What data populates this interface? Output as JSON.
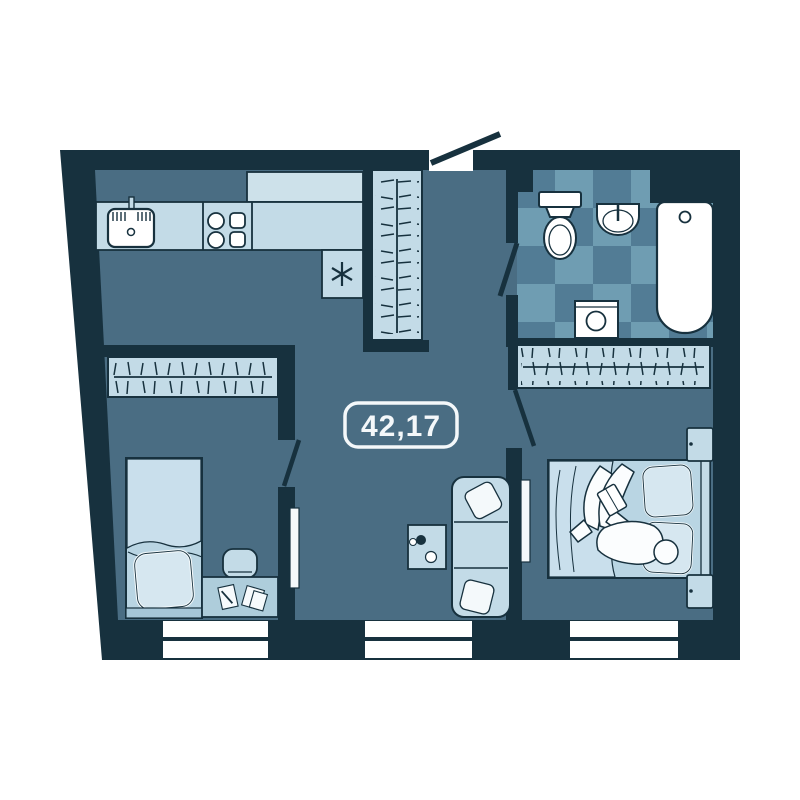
{
  "plan": {
    "type": "apartment-floor-plan",
    "area_label": "42,17",
    "windows_count": 3,
    "rooms": [
      {
        "name": "kitchen-hall",
        "fixtures": [
          "kitchen-sink",
          "stove-4-burners",
          "kitchen-counter",
          "fridge-snowflake",
          "tall-wardrobe-hangers"
        ]
      },
      {
        "name": "bathroom",
        "fixtures": [
          "toilet",
          "washbasin",
          "bathtub",
          "washing-machine",
          "checker-tile-floor"
        ]
      },
      {
        "name": "bedroom-left",
        "fixtures": [
          "single-bed",
          "pillow",
          "desk",
          "chair",
          "papers",
          "wardrobe-hangers"
        ]
      },
      {
        "name": "bedroom-right",
        "fixtures": [
          "double-bed",
          "person-reading-book",
          "nightstand",
          "nightstand",
          "wardrobe-hangers"
        ]
      },
      {
        "name": "living-area",
        "fixtures": [
          "sofa-3-seat",
          "sofa-pillows",
          "coffee-table"
        ]
      }
    ],
    "doors": [
      "entrance-door-swing",
      "bathroom-door-swing",
      "bedroom-left-door-swing",
      "bedroom-right-door-swing"
    ]
  },
  "colors": {
    "bg": "#ffffff",
    "wall": "#17313e",
    "outline": "#17313e",
    "floor": "#4a6d83",
    "furnLight": "#c3dbe7",
    "furnMid": "#aecddb",
    "counterTop": "#cde1ea",
    "bedBase": "#b9d5e3",
    "blanket": "#c9dfec",
    "pillow": "#d6e7f0",
    "pillowStroke": "#f4f9fb",
    "person": "#fbfdfe",
    "paper": "#f6fafc",
    "tileA": "#527c95",
    "tileB": "#6f9db2",
    "white": "#ffffff",
    "label": "#f4f8fa",
    "bedFoot": "#a5c6d8"
  }
}
